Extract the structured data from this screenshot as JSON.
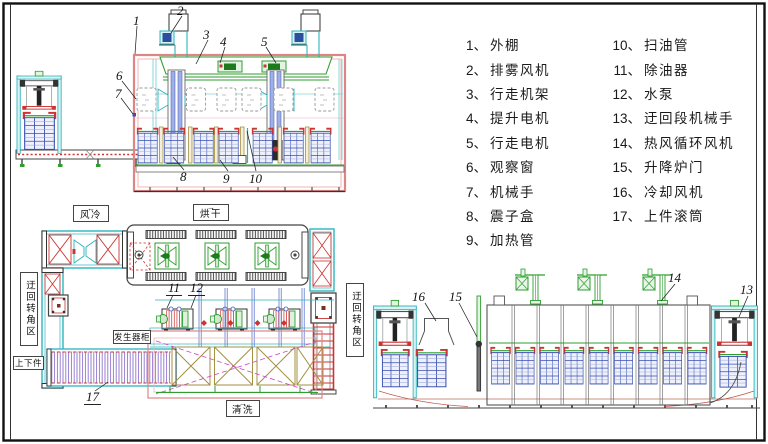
{
  "legend": {
    "col1": [
      {
        "n": "1、",
        "t": "外棚"
      },
      {
        "n": "2、",
        "t": "排雾风机"
      },
      {
        "n": "3、",
        "t": "行走机架"
      },
      {
        "n": "4、",
        "t": "提升电机"
      },
      {
        "n": "5、",
        "t": "行走电机"
      },
      {
        "n": "6、",
        "t": "观察窗"
      },
      {
        "n": "7、",
        "t": "机械手"
      },
      {
        "n": "8、",
        "t": "震子盒"
      },
      {
        "n": "9、",
        "t": "加热管"
      }
    ],
    "col2": [
      {
        "n": "10、",
        "t": "扫油管"
      },
      {
        "n": "11、",
        "t": "除油器"
      },
      {
        "n": "12、",
        "t": "水泵"
      },
      {
        "n": "13、",
        "t": "迂回段机械手"
      },
      {
        "n": "14、",
        "t": "热风循环风机"
      },
      {
        "n": "15、",
        "t": "升降炉门"
      },
      {
        "n": "16、",
        "t": "冷却风机"
      },
      {
        "n": "17、",
        "t": "上件滚筒"
      }
    ]
  },
  "plan": {
    "air_cool": "风冷",
    "air_cool_arrow": "←",
    "dry": "烘干",
    "dry_arrow": "→",
    "clean": "清洗",
    "clean_arrow": "→",
    "generator": "发生器柜",
    "loading": "上下件",
    "detour_left": "迂回转角区",
    "detour_right": "迂回转角区"
  },
  "callouts": {
    "c1": "1",
    "c2": "2",
    "c3": "3",
    "c4": "4",
    "c5": "5",
    "c6": "6",
    "c7": "7",
    "c8": "8",
    "c9": "9",
    "c10": "10",
    "c11": "11",
    "c12": "12",
    "c13": "13",
    "c14": "14",
    "c15": "15",
    "c16": "16",
    "c17": "17"
  },
  "colors": {
    "enclosure_pink": "#e08585",
    "frame_cyan": "#2ab5bd",
    "machine_green": "#2f9e2f",
    "basket_blue": "#3a4fb0",
    "alert_red": "#cc3333",
    "conveyor_purple": "#8f74cc",
    "tank_olive": "#a39040",
    "path_magenta": "#cc44cc"
  }
}
